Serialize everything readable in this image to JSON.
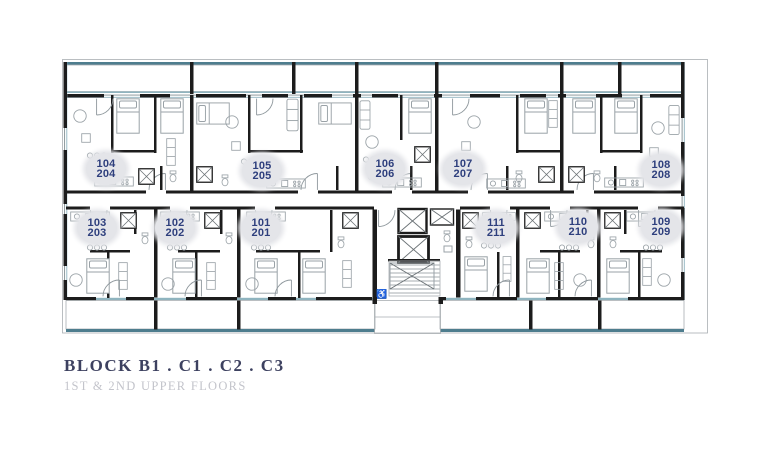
{
  "title": {
    "block": "BLOCK B1 . C1 . C2 . C3",
    "floors": "1ST & 2ND UPPER FLOORS"
  },
  "units": [
    {
      "id": "104-204",
      "line1": "104",
      "line2": "204"
    },
    {
      "id": "105-205",
      "line1": "105",
      "line2": "205"
    },
    {
      "id": "106-206",
      "line1": "106",
      "line2": "206"
    },
    {
      "id": "107-207",
      "line1": "107",
      "line2": "207"
    },
    {
      "id": "108-208",
      "line1": "108",
      "line2": "208"
    },
    {
      "id": "103-203",
      "line1": "103",
      "line2": "203"
    },
    {
      "id": "102-202",
      "line1": "102",
      "line2": "202"
    },
    {
      "id": "101-201",
      "line1": "101",
      "line2": "201"
    },
    {
      "id": "111-211",
      "line1": "111",
      "line2": "211"
    },
    {
      "id": "110-210",
      "line1": "110",
      "line2": "210"
    },
    {
      "id": "109-209",
      "line1": "109",
      "line2": "209"
    }
  ],
  "core": {
    "accessible_symbol": "♿"
  },
  "colors": {
    "wall": "#1c1c1c",
    "teal": "#4e7d8e",
    "teal_light": "#8fb4bf",
    "grid": "#c9cdd0",
    "furniture": "#9aa2a7",
    "label_text": "#2e3f7d",
    "label_bg": "#e4e5e9",
    "title_text": "#3d4160",
    "subtitle_text": "#c3c4cb"
  }
}
